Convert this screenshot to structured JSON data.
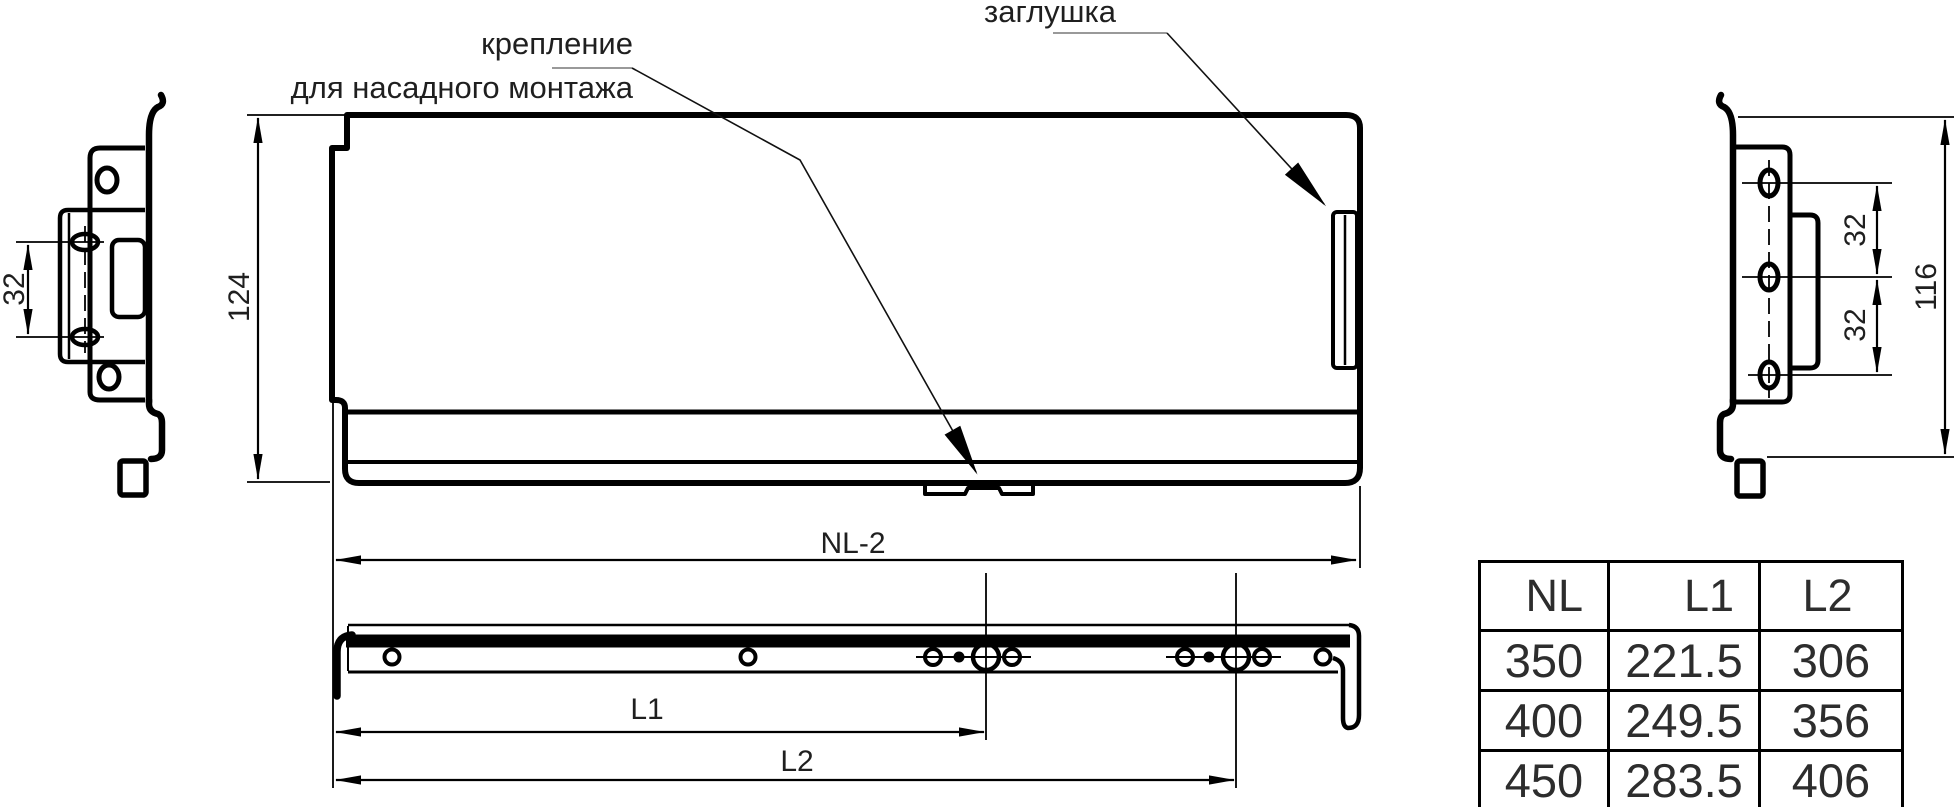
{
  "labels": {
    "mount_line1": "крепление",
    "mount_line2": "для насадного монтажа",
    "plug": "заглушка"
  },
  "dimensions": {
    "side_height": "124",
    "length": "NL-2",
    "l1": "L1",
    "l2": "L2",
    "left_hole_spacing": "32",
    "right_spacing_top": "32",
    "right_spacing_bottom": "32",
    "right_height": "116"
  },
  "table": {
    "headers": [
      "NL",
      "L1",
      "L2"
    ],
    "rows": [
      [
        "350",
        "221.5",
        "306"
      ],
      [
        "400",
        "249.5",
        "356"
      ],
      [
        "450",
        "283.5",
        "406"
      ]
    ]
  },
  "colors": {
    "line": "#000000",
    "leader_underline": "#999999",
    "text": "#1f1f1f"
  }
}
